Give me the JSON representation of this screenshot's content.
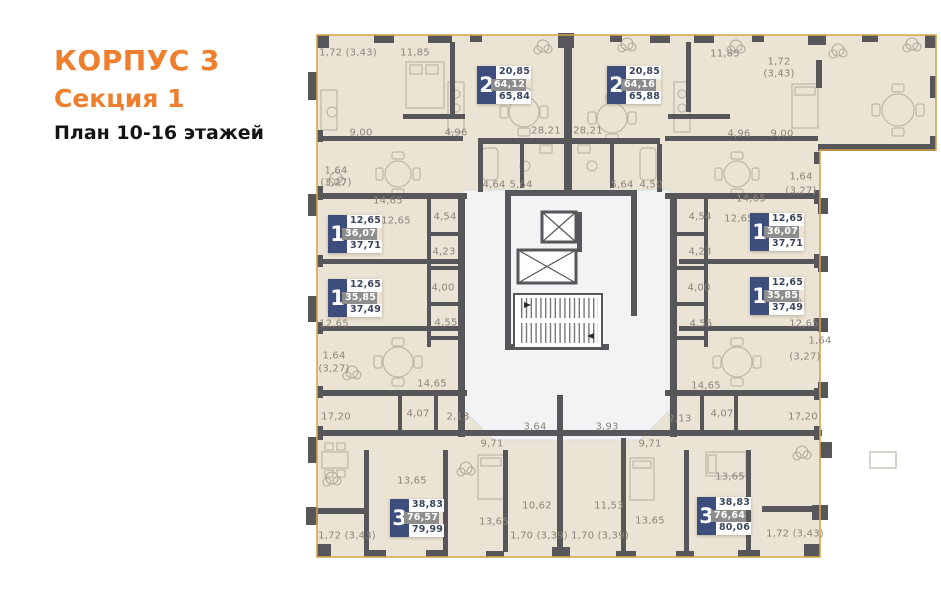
{
  "header": {
    "building": "КОРПУС 3",
    "section": "Секция 1",
    "plan": "План 10-16 этажей"
  },
  "colors": {
    "accent_orange": "#EE7F2E",
    "badge_blue": "#3D4E7C",
    "badge_gray": "#8D8D8D",
    "wall": "#57565A",
    "apartment_fill": "#EBE3D3",
    "common_fill": "#F2F3F5",
    "outline_gold": "#D4A54B",
    "dim_text": "#8B857C"
  },
  "apartments": [
    {
      "id": "2-left",
      "rooms": "2",
      "living_area": "20,85",
      "area_no_balcony": "64,12",
      "area_total": "65,84",
      "x": 477,
      "y": 66
    },
    {
      "id": "2-right",
      "rooms": "2",
      "living_area": "20,85",
      "area_no_balcony": "64,16",
      "area_total": "65,88",
      "x": 607,
      "y": 66
    },
    {
      "id": "1-left-upper",
      "rooms": "1",
      "living_area": "12,65",
      "area_no_balcony": "36,07",
      "area_total": "37,71",
      "x": 328,
      "y": 215
    },
    {
      "id": "1-left-lower",
      "rooms": "1",
      "living_area": "12,65",
      "area_no_balcony": "35,85",
      "area_total": "37,49",
      "x": 328,
      "y": 279
    },
    {
      "id": "1-right-upper",
      "rooms": "1",
      "living_area": "12,65",
      "area_no_balcony": "36,07",
      "area_total": "37,71",
      "x": 750,
      "y": 213
    },
    {
      "id": "1-right-lower",
      "rooms": "1",
      "living_area": "12,65",
      "area_no_balcony": "35,85",
      "area_total": "37,49",
      "x": 750,
      "y": 277
    },
    {
      "id": "3-left",
      "rooms": "3",
      "living_area": "38,83",
      "area_no_balcony": "76,57",
      "area_total": "79,99",
      "x": 390,
      "y": 499
    },
    {
      "id": "3-right",
      "rooms": "3",
      "living_area": "38,83",
      "area_no_balcony": "76,64",
      "area_total": "80,06",
      "x": 697,
      "y": 497
    }
  ],
  "dimension_labels": [
    {
      "text": "1,72 (3,43)",
      "x": 348,
      "y": 53
    },
    {
      "text": "11,85",
      "x": 415,
      "y": 53
    },
    {
      "text": "11,85",
      "x": 725,
      "y": 54
    },
    {
      "text": "1,72",
      "x": 779,
      "y": 62
    },
    {
      "text": "(3,43)",
      "x": 779,
      "y": 74
    },
    {
      "text": "9,00",
      "x": 361,
      "y": 133
    },
    {
      "text": "4,96",
      "x": 456,
      "y": 133
    },
    {
      "text": "28,21",
      "x": 546,
      "y": 131
    },
    {
      "text": "28,21",
      "x": 588,
      "y": 131
    },
    {
      "text": "4,96",
      "x": 739,
      "y": 134
    },
    {
      "text": "9,00",
      "x": 782,
      "y": 134
    },
    {
      "text": "1,64",
      "x": 336,
      "y": 171
    },
    {
      "text": "(3,27)",
      "x": 336,
      "y": 183
    },
    {
      "text": "1,64",
      "x": 801,
      "y": 177
    },
    {
      "text": "(3,27)",
      "x": 801,
      "y": 191
    },
    {
      "text": "4,64",
      "x": 494,
      "y": 185
    },
    {
      "text": "5,64",
      "x": 521,
      "y": 185
    },
    {
      "text": "5,64",
      "x": 622,
      "y": 185
    },
    {
      "text": "4,50",
      "x": 651,
      "y": 185
    },
    {
      "text": "14,65",
      "x": 388,
      "y": 201
    },
    {
      "text": "12,65",
      "x": 396,
      "y": 221
    },
    {
      "text": "14,65",
      "x": 751,
      "y": 199
    },
    {
      "text": "12,65",
      "x": 739,
      "y": 219
    },
    {
      "text": "4,54",
      "x": 445,
      "y": 217
    },
    {
      "text": "4,54",
      "x": 700,
      "y": 217
    },
    {
      "text": "4,23",
      "x": 444,
      "y": 252
    },
    {
      "text": "4,23",
      "x": 700,
      "y": 252
    },
    {
      "text": "4,00",
      "x": 443,
      "y": 288
    },
    {
      "text": "4,00",
      "x": 699,
      "y": 288
    },
    {
      "text": "4,55",
      "x": 446,
      "y": 323
    },
    {
      "text": "4,55",
      "x": 701,
      "y": 324
    },
    {
      "text": "12,65",
      "x": 334,
      "y": 324
    },
    {
      "text": "12,65",
      "x": 804,
      "y": 324
    },
    {
      "text": "1,64",
      "x": 334,
      "y": 356
    },
    {
      "text": "(3,27)",
      "x": 334,
      "y": 369
    },
    {
      "text": "1,64",
      "x": 820,
      "y": 341
    },
    {
      "text": "(3,27)",
      "x": 805,
      "y": 357
    },
    {
      "text": "14,65",
      "x": 432,
      "y": 384
    },
    {
      "text": "14,65",
      "x": 706,
      "y": 386
    },
    {
      "text": "17,20",
      "x": 336,
      "y": 417
    },
    {
      "text": "17,20",
      "x": 803,
      "y": 417
    },
    {
      "text": "4,07",
      "x": 418,
      "y": 414
    },
    {
      "text": "4,07",
      "x": 722,
      "y": 414
    },
    {
      "text": "2,13",
      "x": 458,
      "y": 417
    },
    {
      "text": "2,13",
      "x": 680,
      "y": 419
    },
    {
      "text": "3,64",
      "x": 535,
      "y": 427
    },
    {
      "text": "3,93",
      "x": 607,
      "y": 427
    },
    {
      "text": "9,71",
      "x": 492,
      "y": 444
    },
    {
      "text": "9,71",
      "x": 650,
      "y": 444
    },
    {
      "text": "13,65",
      "x": 412,
      "y": 481
    },
    {
      "text": "13,65",
      "x": 730,
      "y": 477
    },
    {
      "text": "10,62",
      "x": 537,
      "y": 506
    },
    {
      "text": "11,53",
      "x": 609,
      "y": 506
    },
    {
      "text": "13,65",
      "x": 494,
      "y": 522
    },
    {
      "text": "13,65",
      "x": 650,
      "y": 521
    },
    {
      "text": "1,72 (3,43)",
      "x": 347,
      "y": 536
    },
    {
      "text": "1,70 (3,39)",
      "x": 539,
      "y": 536
    },
    {
      "text": "1,70 (3,39)",
      "x": 600,
      "y": 536
    },
    {
      "text": "1,72 (3,43)",
      "x": 795,
      "y": 534
    }
  ]
}
